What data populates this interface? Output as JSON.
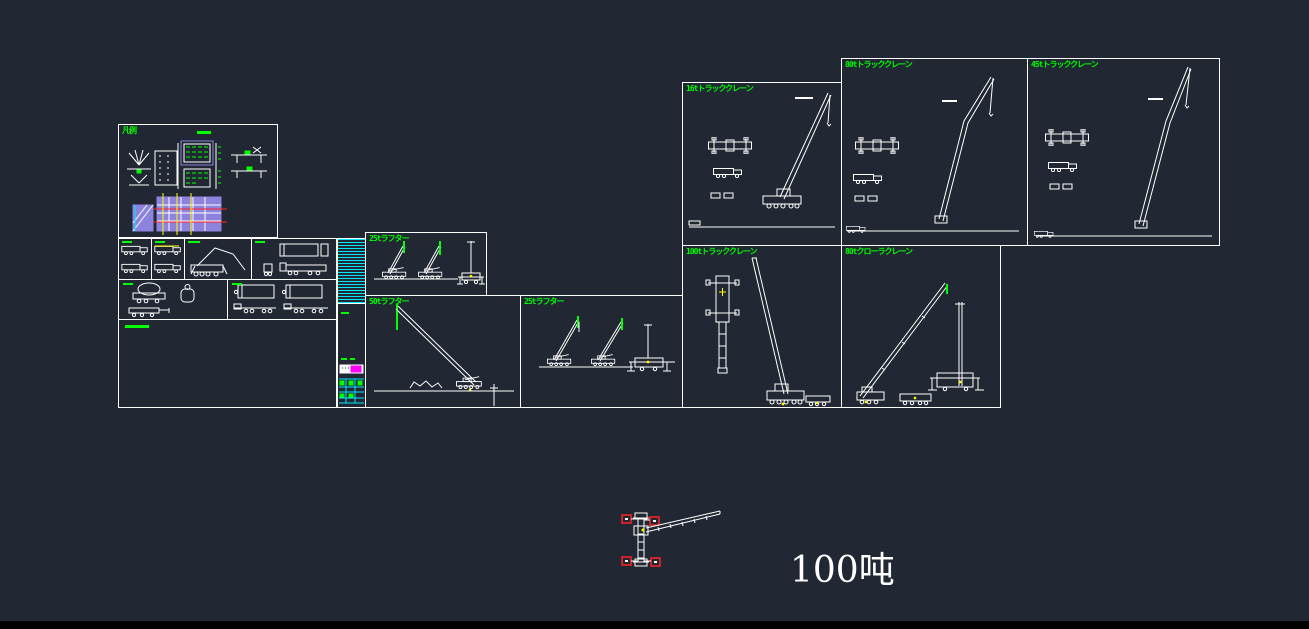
{
  "canvas": {
    "background": "#212833",
    "bottom_bar_color": "#000000"
  },
  "colors": {
    "line": "#ffffff",
    "label_green": "#00ff00",
    "hatch_cyan": "#00e8ff",
    "highlight_magenta": "#ff00ff",
    "outrigger_red": "#ff2222",
    "dot_yellow": "#ffff00",
    "block_violet": "#8d82dd"
  },
  "legend_panel": {
    "title": "凡例"
  },
  "panels": {
    "rafter25a": {
      "label": "25tラフター"
    },
    "rafter50": {
      "label": "50tラフター"
    },
    "rafter25b": {
      "label": "25tラフター"
    },
    "truck16": {
      "label": "16tトラッククレーン"
    },
    "truck80": {
      "label": "80tトラッククレーン"
    },
    "truck45": {
      "label": "45tトラッククレーン"
    },
    "truck100": {
      "label": "100tトラッククレーン"
    },
    "crawler80": {
      "label": "80tクローラクレーン"
    }
  },
  "annotation": {
    "tonnage": "100吨"
  }
}
